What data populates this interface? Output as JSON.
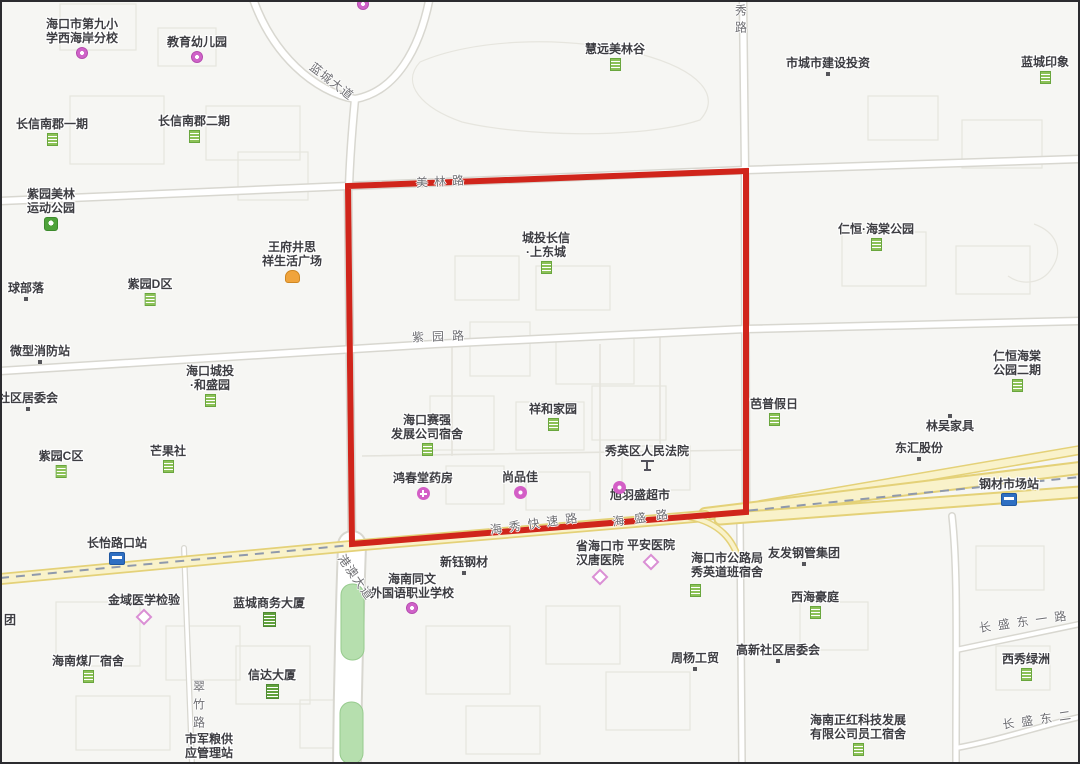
{
  "map": {
    "description_note": "street map with red highlighted block",
    "background_color": "#f6f6f3",
    "highlight_box": {
      "color": "#d0251b",
      "corners": [
        [
          348,
          186
        ],
        [
          746,
          171
        ],
        [
          746,
          512
        ],
        [
          352,
          544
        ]
      ]
    },
    "poi_labels": [
      {
        "name": "haikou-9th-primary-school-west-coast-branch",
        "lines": [
          "海口市第九小",
          "学西海岸分校"
        ],
        "x": 82,
        "y": 17,
        "icon": "school",
        "icon_pos": "below"
      },
      {
        "name": "education-kindergarten",
        "lines": [
          "教育幼儿园"
        ],
        "x": 197,
        "y": 35,
        "icon": "school",
        "icon_pos": "below"
      },
      {
        "name": "huiyuan-meilin-valley",
        "lines": [
          "慧远美林谷"
        ],
        "x": 615,
        "y": 42,
        "icon": "residence",
        "icon_pos": "below"
      },
      {
        "name": "city-construction-investment",
        "lines": [
          "市城市建设投资"
        ],
        "x": 828,
        "y": 56,
        "icon": "dot",
        "icon_pos": "below"
      },
      {
        "name": "lancheng-impression",
        "lines": [
          "蓝城印象"
        ],
        "x": 1045,
        "y": 55,
        "icon": "residence",
        "icon_pos": "below"
      },
      {
        "name": "changxin-nanjun-phase1",
        "lines": [
          "长信南郡一期"
        ],
        "x": 52,
        "y": 117,
        "icon": "residence",
        "icon_pos": "below"
      },
      {
        "name": "changxin-nanjun-phase2",
        "lines": [
          "长信南郡二期"
        ],
        "x": 194,
        "y": 114,
        "icon": "residence",
        "icon_pos": "below"
      },
      {
        "name": "ziyuan-meilin-sports-park",
        "lines": [
          "紫园美林",
          "运动公园"
        ],
        "x": 51,
        "y": 187,
        "icon": "park",
        "icon_pos": "below"
      },
      {
        "name": "renheng-haitang-park",
        "lines": [
          "仁恒·海棠公园"
        ],
        "x": 876,
        "y": 222,
        "icon": "residence",
        "icon_pos": "below"
      },
      {
        "name": "wangfujing-sixiang-life-plaza",
        "lines": [
          "王府井思",
          "祥生活广场"
        ],
        "x": 292,
        "y": 240,
        "icon": "mall",
        "icon_pos": "below"
      },
      {
        "name": "chengtou-changxin-shangdongcheng",
        "lines": [
          "城投长信",
          "·上东城"
        ],
        "x": 546,
        "y": 231,
        "icon": "residence",
        "icon_pos": "below"
      },
      {
        "name": "qiu-buluo",
        "lines": [
          "球部落"
        ],
        "x": 26,
        "y": 281,
        "icon": "dot",
        "icon_pos": "below"
      },
      {
        "name": "ziyuan-d-zone",
        "lines": [
          "紫园D区"
        ],
        "x": 150,
        "y": 277,
        "icon": "residence",
        "icon_pos": "below"
      },
      {
        "name": "micro-fire-station",
        "lines": [
          "微型消防站"
        ],
        "x": 40,
        "y": 344,
        "icon": "dot",
        "icon_pos": "below"
      },
      {
        "name": "haikou-chengtou-heshengyuan",
        "lines": [
          "海口城投",
          "·和盛园"
        ],
        "x": 210,
        "y": 364,
        "icon": "residence",
        "icon_pos": "below"
      },
      {
        "name": "community-committee",
        "lines": [
          "社区居委会"
        ],
        "x": 28,
        "y": 391,
        "icon": "dot",
        "icon_pos": "below"
      },
      {
        "name": "ziyuan-c-zone",
        "lines": [
          "紫园C区"
        ],
        "x": 61,
        "y": 449,
        "icon": "residence",
        "icon_pos": "below"
      },
      {
        "name": "mangguoshe",
        "lines": [
          "芒果社"
        ],
        "x": 168,
        "y": 444,
        "icon": "residence",
        "icon_pos": "below"
      },
      {
        "name": "haikou-saiqiang-dormitory",
        "lines": [
          "海口赛强",
          "发展公司宿舍"
        ],
        "x": 427,
        "y": 413,
        "icon": "residence",
        "icon_pos": "below"
      },
      {
        "name": "xianghe-jiayuan",
        "lines": [
          "祥和家园"
        ],
        "x": 553,
        "y": 402,
        "icon": "residence",
        "icon_pos": "below"
      },
      {
        "name": "xiuying-district-peoples-court",
        "lines": [
          "秀英区人民法院"
        ],
        "x": 647,
        "y": 444,
        "icon": "court",
        "icon_pos": "below"
      },
      {
        "name": "hongchuntang-pharmacy",
        "lines": [
          "鸿春堂药房"
        ],
        "x": 423,
        "y": 471,
        "icon": "pharmacy",
        "icon_pos": "below"
      },
      {
        "name": "shangpinjia",
        "lines": [
          "尚品佳"
        ],
        "x": 520,
        "y": 470,
        "icon": "shop",
        "icon_pos": "below"
      },
      {
        "name": "xuyusheng-supermarket",
        "lines": [
          "旭羽盛超市"
        ],
        "x": 640,
        "y": 488,
        "icon": "none",
        "icon_pos": "below"
      },
      {
        "name": "bapu-holiday",
        "lines": [
          "芭普假日"
        ],
        "x": 774,
        "y": 397,
        "icon": "residence",
        "icon_pos": "below"
      },
      {
        "name": "renheng-haitang-park-phase2",
        "lines": [
          "仁恒海棠",
          "公园二期"
        ],
        "x": 1017,
        "y": 349,
        "icon": "residence",
        "icon_pos": "below"
      },
      {
        "name": "linwu-furniture",
        "lines": [
          "林吴家具"
        ],
        "x": 950,
        "y": 419,
        "icon": "none",
        "icon_pos": "below"
      },
      {
        "name": "donghui-gufen",
        "lines": [
          "东汇股份"
        ],
        "x": 919,
        "y": 441,
        "icon": "dot",
        "icon_pos": "below"
      },
      {
        "name": "steel-market-station",
        "lines": [
          "钢材市场站"
        ],
        "x": 1009,
        "y": 477,
        "icon": "bus",
        "icon_pos": "below"
      },
      {
        "name": "changyi-road-crossing-station",
        "lines": [
          "长怡路口站"
        ],
        "x": 117,
        "y": 536,
        "icon": "bus",
        "icon_pos": "below"
      },
      {
        "name": "jinyu-medical-lab",
        "lines": [
          "金域医学检验"
        ],
        "x": 144,
        "y": 593,
        "icon": "hospital",
        "icon_pos": "below"
      },
      {
        "name": "lancheng-business-building",
        "lines": [
          "蓝城商务大厦"
        ],
        "x": 269,
        "y": 596,
        "icon": "office",
        "icon_pos": "below"
      },
      {
        "name": "tuan-partial",
        "lines": [
          "团"
        ],
        "x": 10,
        "y": 613,
        "icon": "none",
        "icon_pos": "below"
      },
      {
        "name": "hainan-coal-factory-dormitory",
        "lines": [
          "海南煤厂宿舍"
        ],
        "x": 88,
        "y": 654,
        "icon": "residence",
        "icon_pos": "below"
      },
      {
        "name": "xinda-building",
        "lines": [
          "信达大厦"
        ],
        "x": 272,
        "y": 668,
        "icon": "office",
        "icon_pos": "below"
      },
      {
        "name": "city-military-grain-station",
        "lines": [
          "市军粮供",
          "应管理站"
        ],
        "x": 209,
        "y": 732,
        "icon": "none",
        "icon_pos": "below"
      },
      {
        "name": "hainan-tongwen-foreign-language-school",
        "lines": [
          "海南同文",
          "外国语职业学校"
        ],
        "x": 412,
        "y": 572,
        "icon": "school",
        "icon_pos": "below"
      },
      {
        "name": "xinyu-steel",
        "lines": [
          "新钰钢材"
        ],
        "x": 464,
        "y": 555,
        "icon": "dot",
        "icon_pos": "below"
      },
      {
        "name": "hantang-hospital",
        "lines": [
          "省海口市",
          "汉唐医院"
        ],
        "x": 600,
        "y": 539,
        "icon": "hospital",
        "icon_pos": "below"
      },
      {
        "name": "pingan-hospital",
        "lines": [
          "平安医院"
        ],
        "x": 651,
        "y": 538,
        "icon": "hospital",
        "icon_pos": "below"
      },
      {
        "name": "highway-bureau-dormitory",
        "lines": [
          "海口市公路局",
          "秀英道班宿舍"
        ],
        "x": 727,
        "y": 551,
        "icon": "none",
        "icon_pos": "below"
      },
      {
        "name": "youfa-steel-pipe-group",
        "lines": [
          "友发钢管集团"
        ],
        "x": 804,
        "y": 546,
        "icon": "dot",
        "icon_pos": "below"
      },
      {
        "name": "xihai-haoting",
        "lines": [
          "西海豪庭"
        ],
        "x": 815,
        "y": 590,
        "icon": "residence",
        "icon_pos": "below"
      },
      {
        "name": "gaoxin-community-committee",
        "lines": [
          "高新社区居委会"
        ],
        "x": 778,
        "y": 643,
        "icon": "dot",
        "icon_pos": "below"
      },
      {
        "name": "zhouyang-gongmao",
        "lines": [
          "周杨工贸"
        ],
        "x": 695,
        "y": 651,
        "icon": "dot",
        "icon_pos": "below"
      },
      {
        "name": "xixiu-oasis",
        "lines": [
          "西秀绿洲"
        ],
        "x": 1026,
        "y": 652,
        "icon": "residence",
        "icon_pos": "below"
      },
      {
        "name": "hainan-zhenghong-tech-dormitory",
        "lines": [
          "海南正红科技发展",
          "有限公司员工宿舍"
        ],
        "x": 858,
        "y": 713,
        "icon": "residence",
        "icon_pos": "below"
      }
    ],
    "standalone_icons": [
      {
        "icon": "shop",
        "x": 613,
        "y": 479
      },
      {
        "icon": "dot",
        "x": 948,
        "y": 412
      },
      {
        "icon": "residence",
        "x": 690,
        "y": 582
      },
      {
        "icon": "school",
        "x": 357,
        "y": -4
      }
    ],
    "road_labels": [
      {
        "text": "美林路",
        "x": 443,
        "y": 181,
        "rotate": -3,
        "spacing": 6,
        "vertical": false
      },
      {
        "text": "紫园路",
        "x": 442,
        "y": 336,
        "rotate": -2,
        "spacing": 8,
        "vertical": false
      },
      {
        "text": "蓝城大道",
        "x": 332,
        "y": 81,
        "rotate": 38,
        "spacing": 1,
        "vertical": false
      },
      {
        "text": "秀路",
        "x": 741,
        "y": 4,
        "rotate": 0,
        "spacing": 5,
        "vertical": true
      },
      {
        "text": "港澳大道",
        "x": 356,
        "y": 577,
        "rotate": 55,
        "spacing": 1,
        "vertical": false
      },
      {
        "text": "翠竹路",
        "x": 199,
        "y": 680,
        "rotate": 0,
        "spacing": 6,
        "vertical": true
      },
      {
        "text": "海秀快速路",
        "x": 537,
        "y": 523,
        "rotate": -8,
        "spacing": 7,
        "vertical": false
      },
      {
        "text": "海盛路",
        "x": 645,
        "y": 517,
        "rotate": -8,
        "spacing": 10,
        "vertical": false
      },
      {
        "text": "长盛东一路",
        "x": 1026,
        "y": 621,
        "rotate": -8,
        "spacing": 7,
        "vertical": false
      },
      {
        "text": "长盛东二",
        "x": 1040,
        "y": 719,
        "rotate": -8,
        "spacing": 7,
        "vertical": false
      }
    ]
  }
}
